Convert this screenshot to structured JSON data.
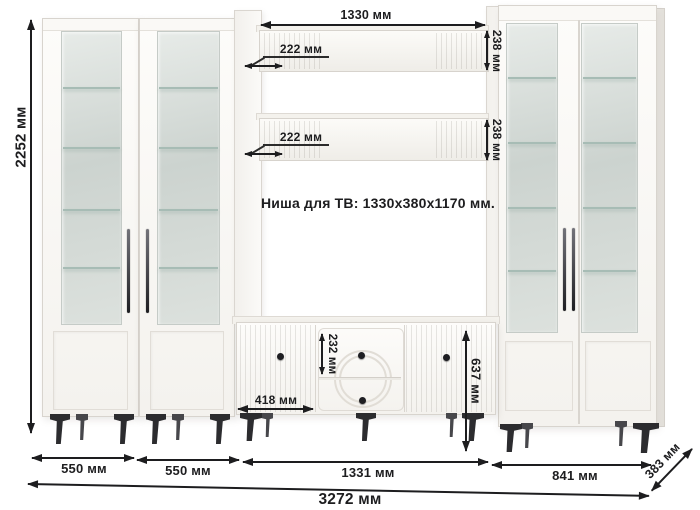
{
  "diagram": {
    "niche_label": "Ниша для ТВ: 1330x380x1170 мм.",
    "dims": {
      "total_height": "2252 мм",
      "top_shelf_length": "1330 мм",
      "top_shelf_depth": "222 мм",
      "middle_shelf_depth": "222 мм",
      "top_shelf_height": "238 мм",
      "middle_shelf_height": "238 мм",
      "drawer_height": "232 мм",
      "stand_door_width": "418 мм",
      "stand_height": "637 мм",
      "left_cabinet1_width": "550 мм",
      "left_cabinet2_width": "550 мм",
      "center_section_width": "1331 мм",
      "right_cabinet_width": "841 мм",
      "total_width": "3272 мм",
      "total_depth": "383 мм"
    },
    "colors": {
      "dimension_ink": "#1d1d1f",
      "cabinet_body": "#faf9f6",
      "glass_tint": "#d5dbd7",
      "hardware_black": "#2c2c2f"
    }
  }
}
